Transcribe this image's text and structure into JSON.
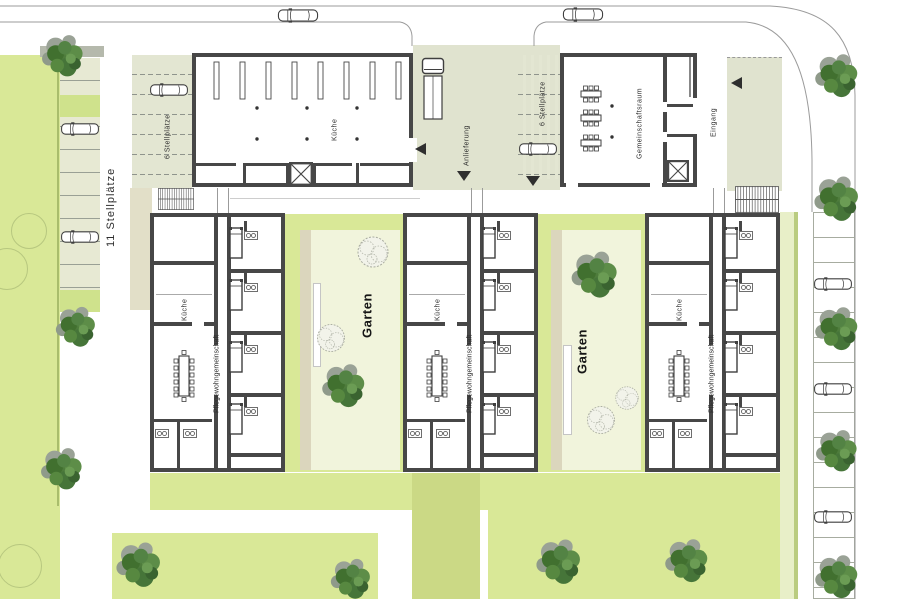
{
  "plan": {
    "labels": {
      "parking_11": "11 Stellplätze",
      "parking_6": "6 Stellplätze",
      "kitchen": "Küche",
      "care_unit": "Pflegewohngemeinschaft",
      "garden": "Garten",
      "delivery": "Anlieferung",
      "community_room": "Gemeinschaftsraum",
      "entrance": "Eingang"
    },
    "colors": {
      "lawn": "#d9e897",
      "garden_inner": "#f1f4dc",
      "paving": "#e0e3cf",
      "parking_strip": "#e7e9d3",
      "planting_strip": "#dbd6bd",
      "path_strip": "#e8efc8",
      "dark_green_band": "#cbd985",
      "wall": "#474747",
      "road_line": "#9b9b9b",
      "tree_canopy": "#4e7c3c",
      "tree_shadow": "#9aa296",
      "label_text": "#2d2d2d"
    }
  }
}
